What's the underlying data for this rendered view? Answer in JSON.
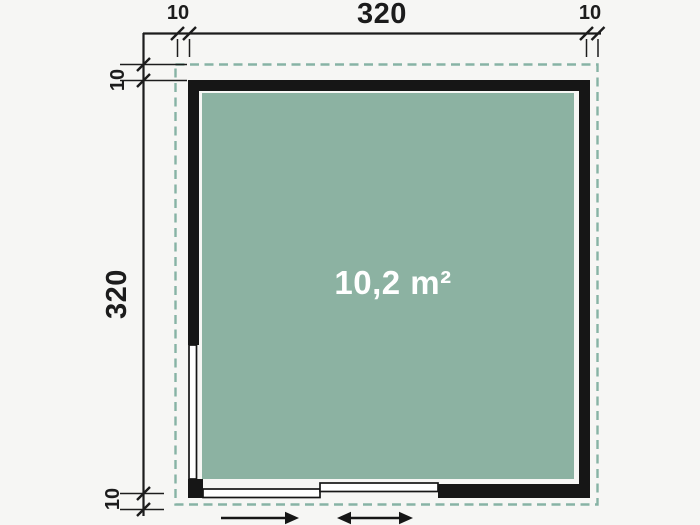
{
  "plan": {
    "area_label": "10,2 m²",
    "dim_top_width": "320",
    "dim_side_height": "320",
    "dim_overhang_top_left": "10",
    "dim_overhang_top_right": "10",
    "dim_overhang_side_top": "10",
    "dim_overhang_side_bottom": "10",
    "colors": {
      "background": "#f6f6f4",
      "floor": "#8cb2a2",
      "roof_dash": "#87b3a5",
      "wall": "#161616",
      "dim_line": "#1c1c1c",
      "area_text": "#ffffff"
    }
  }
}
